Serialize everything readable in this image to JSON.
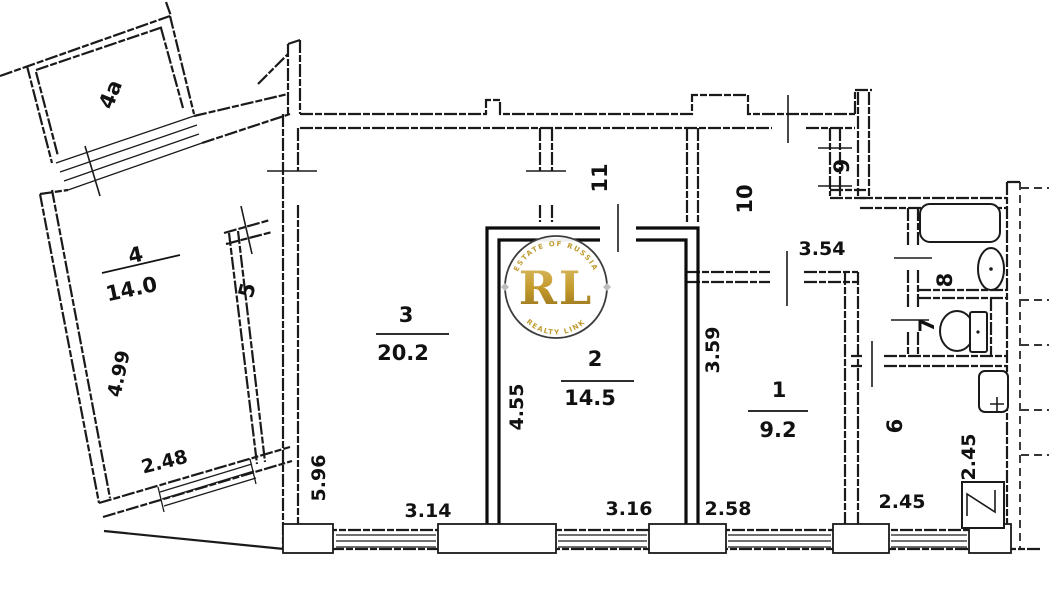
{
  "title": "apartment floor plan",
  "colors": {
    "ink": "#1a1a1a",
    "bold_ink": "#0c0c0c",
    "gold": "#bf9b30"
  },
  "rooms": {
    "r4a": {
      "label": "4а"
    },
    "r4": {
      "label": "4",
      "area": "14.0"
    },
    "r5": {
      "label": "5"
    },
    "r3": {
      "label": "3",
      "area": "20.2"
    },
    "r2": {
      "label": "2",
      "area": "14.5"
    },
    "r1": {
      "label": "1",
      "area": "9.2"
    },
    "r6": {
      "label": "6"
    },
    "r7": {
      "label": "7"
    },
    "r8": {
      "label": "8"
    },
    "r9": {
      "label": "9"
    },
    "r10": {
      "label": "10"
    },
    "r11": {
      "label": "11"
    }
  },
  "dimensions": {
    "room4_length": "4.99",
    "room4_width": "2.48",
    "room3_length": "5.96",
    "room3_width": "3.14",
    "room2_length": "4.55",
    "room2_width": "3.16",
    "room1_length": "3.59",
    "room1_width": "2.58",
    "hall10_width": "3.54",
    "kitchen_width": "2.45",
    "kitchen_depth": "2.45"
  },
  "watermark": {
    "initials": "RL",
    "arc_top": "ESTATE OF RUSSIA",
    "arc_bottom": "REALTY LINK"
  }
}
